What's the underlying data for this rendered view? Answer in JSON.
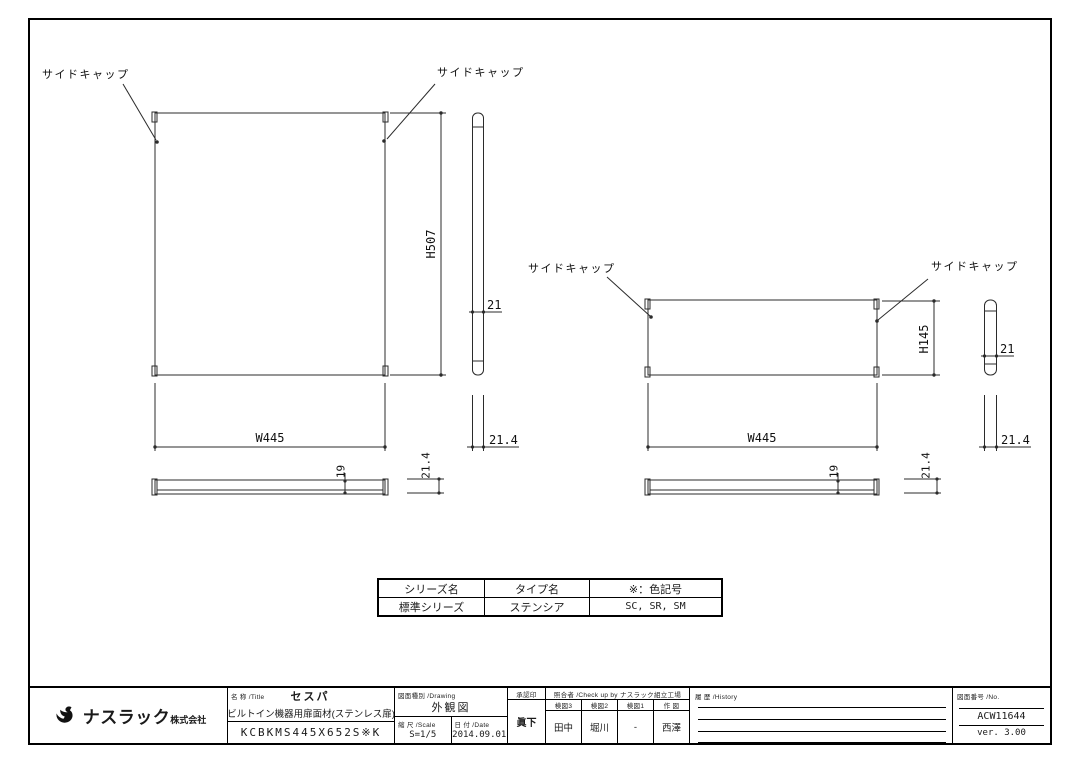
{
  "views": {
    "side_cap_label": "サイドキャップ",
    "large_panel": {
      "height": "H507",
      "width": "W445",
      "thickness": "21",
      "edge": "21.4",
      "inner": "19"
    },
    "small_panel": {
      "height": "H145",
      "width": "W445",
      "thickness": "21",
      "edge": "21.4",
      "inner": "19"
    }
  },
  "spec_table": {
    "col1_header": "シリーズ名",
    "col2_header": "タイプ名",
    "col3_header": "※：色記号",
    "col1_value": "標準シリーズ",
    "col2_value": "ステンシア",
    "col3_value": "SC, SR, SM"
  },
  "title_block": {
    "company_main": "ナスラック",
    "company_suffix": "株式会社",
    "title_label": "名 称 /Title",
    "product_name": "セスパ",
    "product_desc": "ビルトイン機器用扉面材(ステンレス扉)",
    "model_number": "KCBKMS445X652S※K",
    "drawing_label": "図面種別 /Drawing",
    "drawing_type": "外観図",
    "scale_label": "縮 尺 /Scale",
    "scale_value": "S=1/5",
    "date_label": "日 付 /Date",
    "date_value": "2014.09.01",
    "approval_label": "承認印",
    "approver": "眞下",
    "checkup_label": "照合者 /Check up by ナスラック組立工場",
    "check1_label": "検図3",
    "check2_label": "検図2",
    "check3_label": "検図1",
    "check4_label": "作 図",
    "check1_name": "田中",
    "check2_name": "堀川",
    "check3_name": "-",
    "check4_name": "西澤",
    "history_label": "履 歴 /History",
    "number_label": "図面番号 /No.",
    "drawing_number": "ACW11644",
    "version": "ver. 3.00"
  }
}
